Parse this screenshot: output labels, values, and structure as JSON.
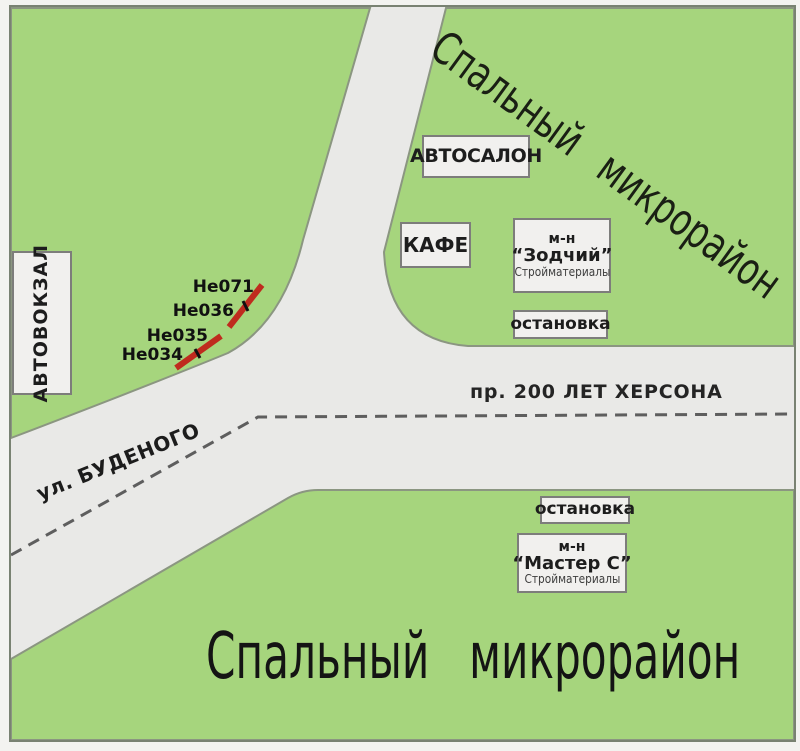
{
  "map": {
    "titles": {
      "district_top": "Спальный микрорайон",
      "district_bottom": "Спальный микрорайон"
    },
    "roads": {
      "avenue": "пр. 200 ЛЕТ ХЕРСОНА",
      "street": "ул. БУДЕНОГО"
    },
    "pois": {
      "bus_terminal": "АВТОВОКЗАЛ",
      "car_dealership": "АВТОСАЛОН",
      "cafe": "КАФЕ",
      "store_zodchiy": {
        "line1": "м-н",
        "line2": "“Зодчий”",
        "line3": "Стройматериалы"
      },
      "bus_stop_north": "остановка",
      "bus_stop_south": "остановка",
      "store_master": {
        "line1": "м-н",
        "line2": "“Мастер С”",
        "line3": "Стройматериалы"
      }
    },
    "markers": [
      {
        "id": "He071"
      },
      {
        "id": "He036"
      },
      {
        "id": "He035"
      },
      {
        "id": "He034"
      }
    ],
    "colors": {
      "district_green": "#a6d57d",
      "road_gray": "#e9e9e7",
      "area_outline": "#8b9681",
      "frame": "#798272",
      "marker_red": "#bf2b1e",
      "centerline_dash": "#5e5e5e"
    }
  }
}
